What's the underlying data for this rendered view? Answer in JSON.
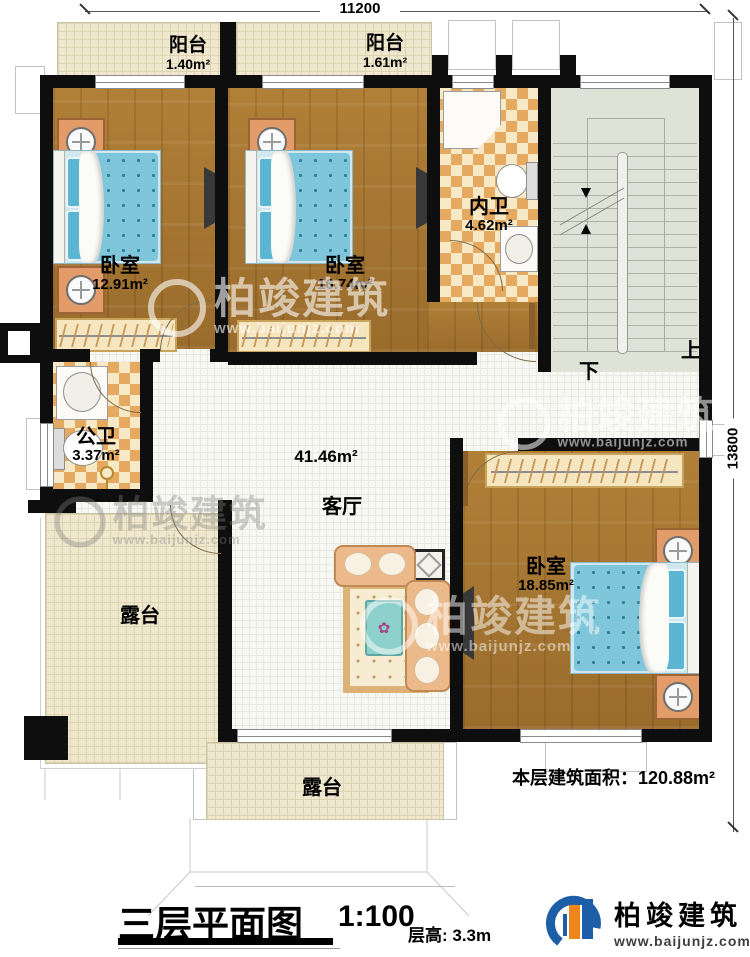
{
  "dimensions": {
    "width_top": "11200",
    "height_right": "13800"
  },
  "rooms": {
    "balcony1": {
      "name": "阳台",
      "area": "1.40m²"
    },
    "balcony2": {
      "name": "阳台",
      "area": "1.61m²"
    },
    "bedroom1": {
      "name": "卧室",
      "area": "12.91m²"
    },
    "bedroom2": {
      "name": "卧室",
      "area": "16.74m²"
    },
    "bedroom3": {
      "name": "卧室",
      "area": "18.85m²"
    },
    "inner_bath": {
      "name": "内卫",
      "area": "4.62m²"
    },
    "public_bath": {
      "name": "公卫",
      "area": "3.37m²"
    },
    "living": {
      "name": "客厅",
      "area": "41.46m²"
    },
    "terrace_left": {
      "name": "露台"
    },
    "terrace_bottom": {
      "name": "露台"
    }
  },
  "stairs": {
    "up_label": "上",
    "down_label": "下"
  },
  "notes": {
    "floor_area": "本层建筑面积：120.88m²"
  },
  "title_block": {
    "title": "三层平面图",
    "scale": "1:100",
    "floor_height": "层高: 3.3m"
  },
  "brand": {
    "name": "柏竣建筑",
    "website": "www.baijunjz.com"
  },
  "colors": {
    "wall": "#0e0e0e",
    "wood": "#a87a38",
    "tile_accent": "#e5a95f",
    "bed_blue": "#7fc6da",
    "brand_blue": "#1c5fa8",
    "brand_orange": "#f08519"
  }
}
